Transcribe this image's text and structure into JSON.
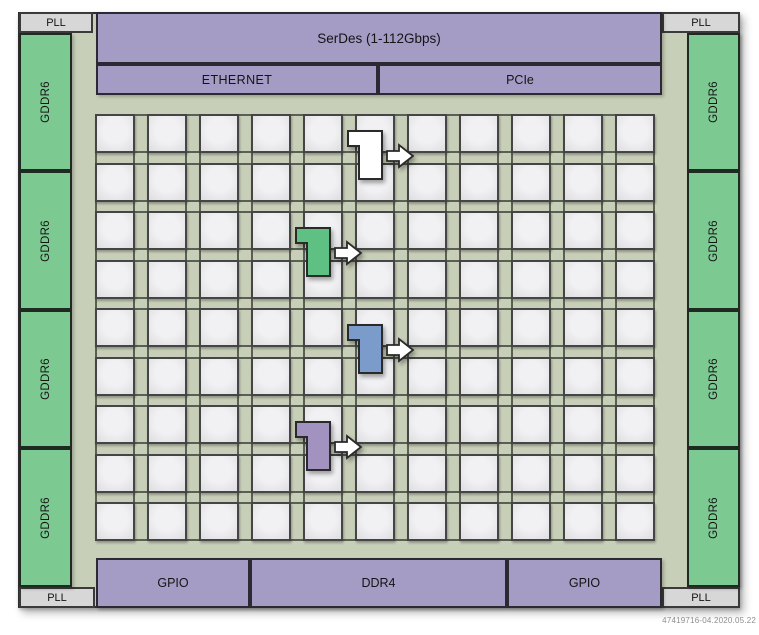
{
  "figure": {
    "watermark": "47419716-04.2020.05.22"
  },
  "chip": {
    "serdes_label": "SerDes (1-112Gbps)",
    "ethernet_label": "ETHERNET",
    "pcie_label": "PCIe",
    "gpio_left_label": "GPIO",
    "ddr4_label": "DDR4",
    "gpio_right_label": "GPIO",
    "pll_labels": [
      "PLL",
      "PLL",
      "PLL",
      "PLL"
    ],
    "gddr6_left_labels": [
      "GDDR6",
      "GDDR6",
      "GDDR6",
      "GDDR6"
    ],
    "gddr6_right_labels": [
      "GDDR6",
      "GDDR6",
      "GDDR6",
      "GDDR6"
    ],
    "grid": {
      "columns": 11,
      "rows": 9
    },
    "highlight_blocks": [
      {
        "id": "white",
        "color": "#ffffff",
        "column": 6,
        "rows": "1-2"
      },
      {
        "id": "green",
        "color": "#5fc083",
        "column": 5,
        "rows": "3-4"
      },
      {
        "id": "blue",
        "color": "#7b9ccb",
        "column": 6,
        "rows": "5-6"
      },
      {
        "id": "purple",
        "color": "#a192c0",
        "column": 5,
        "rows": "7-8"
      }
    ],
    "colors": {
      "die": "#c8cfb8",
      "io_block_purple": "#a59cc5",
      "memory_block_green": "#7cca92",
      "pll_gray": "#d7d7d7",
      "tile_gray": "#ececee",
      "arrow_fill": "#ffffff",
      "outline": "#2a2a2a"
    }
  }
}
